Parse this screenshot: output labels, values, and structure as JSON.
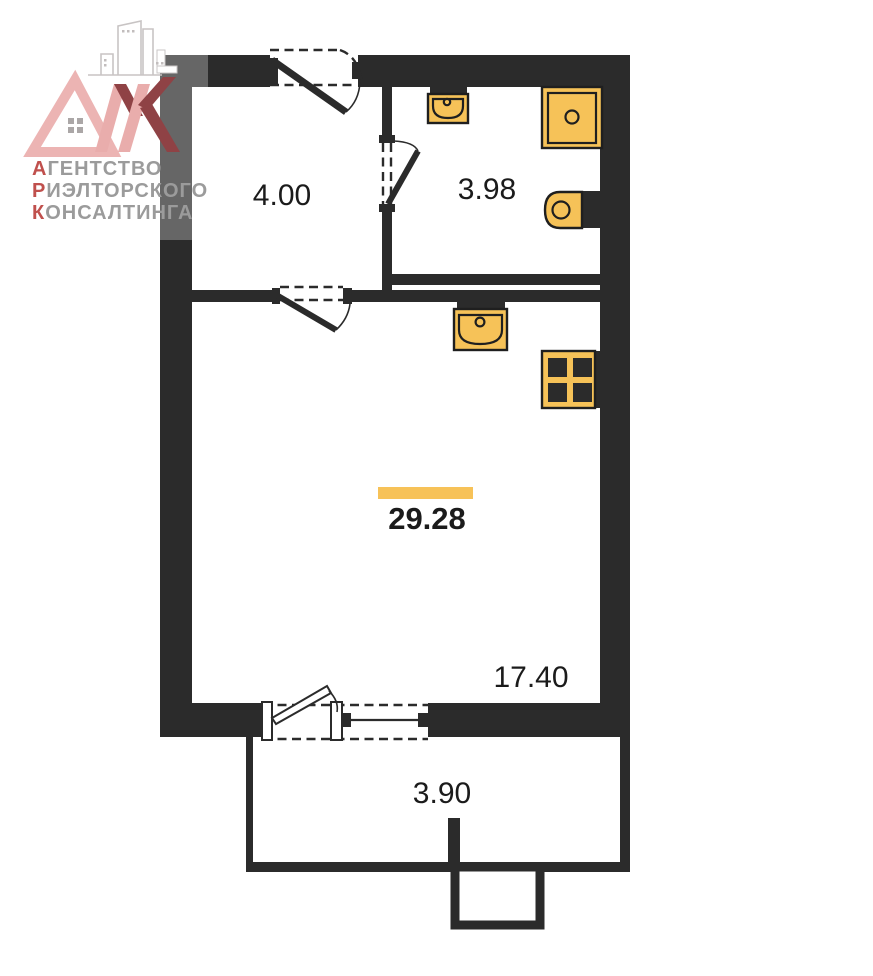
{
  "plan": {
    "total_area": "29.28",
    "areas": {
      "hallway": "4.00",
      "bathroom": "3.98",
      "living_room": "17.40",
      "balcony": "3.90"
    },
    "colors": {
      "wall": "#2B2B2B",
      "fixture_fill": "#F6C258",
      "total_area_marker": "#F7C258"
    }
  },
  "logo": {
    "brand": "АРК",
    "brand_letters": [
      "А",
      "Р",
      "К"
    ],
    "tagline": [
      "АГЕНТСТВО",
      "РИЭЛТОРСКОГО",
      "КОНСАЛТИНГА"
    ],
    "colors": {
      "monogram_light": "#ECB4B3",
      "monogram_dark": "#8F4245",
      "tagline_gray": "#9B9B9B",
      "tagline_accent": "#C0504D"
    }
  }
}
